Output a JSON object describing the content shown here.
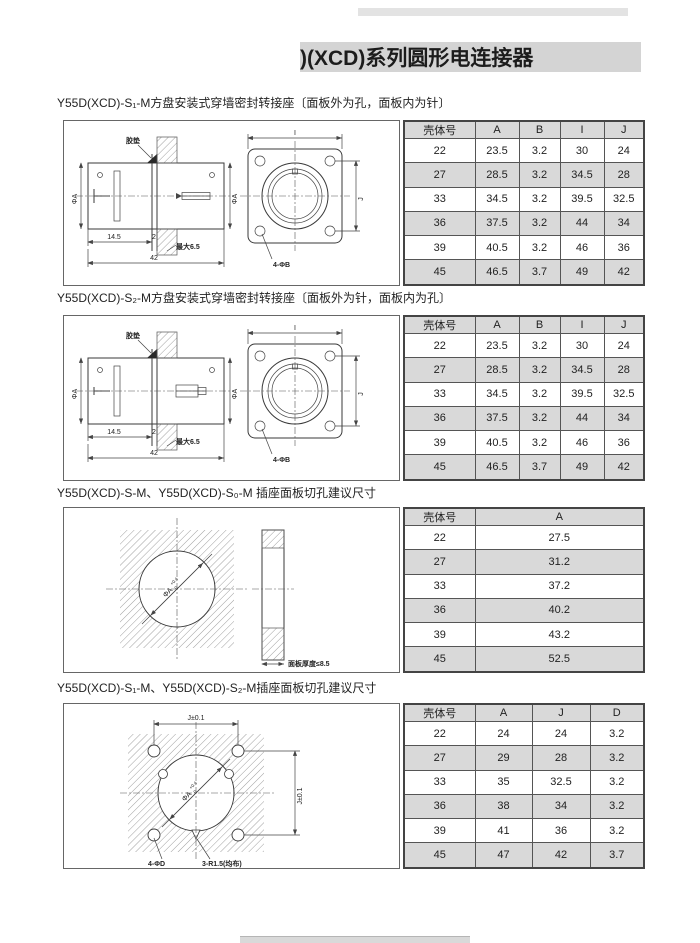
{
  "header": {
    "title": ")(XCD)系列圆形电连接器"
  },
  "sections": [
    {
      "title": "Y55D(XCD)-S₁-M方盘安装式穿墙密封转接座〔面板外为孔，面板内为针〕",
      "drawing": {
        "gasket_label": "胶垫",
        "phi_a_left": "ΦA",
        "phi_a_right": "ΦA",
        "dim_145": "14.5",
        "dim_2": "2",
        "dim_max65": "最大6.5",
        "dim_42": "42",
        "dim_i": "I",
        "dim_j": "J",
        "holes_label": "4-ΦB"
      },
      "table": {
        "columns": [
          "壳体号",
          "A",
          "B",
          "I",
          "J"
        ],
        "rows": [
          [
            "22",
            "23.5",
            "3.2",
            "30",
            "24"
          ],
          [
            "27",
            "28.5",
            "3.2",
            "34.5",
            "28"
          ],
          [
            "33",
            "34.5",
            "3.2",
            "39.5",
            "32.5"
          ],
          [
            "36",
            "37.5",
            "3.2",
            "44",
            "34"
          ],
          [
            "39",
            "40.5",
            "3.2",
            "46",
            "36"
          ],
          [
            "45",
            "46.5",
            "3.7",
            "49",
            "42"
          ]
        ]
      }
    },
    {
      "title": "Y55D(XCD)-S₂-M方盘安装式穿墙密封转接座〔面板外为针，面板内为孔〕",
      "drawing": {
        "gasket_label": "胶垫",
        "phi_a_left": "ΦA",
        "phi_a_right": "ΦA",
        "dim_145": "14.5",
        "dim_2": "2",
        "dim_max65": "最大6.5",
        "dim_42": "42",
        "dim_i": "I",
        "dim_j": "J",
        "holes_label": "4-ΦB"
      },
      "table": {
        "columns": [
          "壳体号",
          "A",
          "B",
          "I",
          "J"
        ],
        "rows": [
          [
            "22",
            "23.5",
            "3.2",
            "30",
            "24"
          ],
          [
            "27",
            "28.5",
            "3.2",
            "34.5",
            "28"
          ],
          [
            "33",
            "34.5",
            "3.2",
            "39.5",
            "32.5"
          ],
          [
            "36",
            "37.5",
            "3.2",
            "44",
            "34"
          ],
          [
            "39",
            "40.5",
            "3.2",
            "46",
            "36"
          ],
          [
            "45",
            "46.5",
            "3.7",
            "49",
            "42"
          ]
        ]
      }
    },
    {
      "title": "Y55D(XCD)-S-M、Y55D(XCD)-S₀-M 插座面板切孔建议尺寸",
      "drawing": {
        "phi_a": "ΦA",
        "tol_plus": "+0.4",
        "tol_zero": "0",
        "thickness_note": "面板厚度≤8.5"
      },
      "table": {
        "columns": [
          "壳体号",
          "A"
        ],
        "rows": [
          [
            "22",
            "27.5"
          ],
          [
            "27",
            "31.2"
          ],
          [
            "33",
            "37.2"
          ],
          [
            "36",
            "40.2"
          ],
          [
            "39",
            "43.2"
          ],
          [
            "45",
            "52.5"
          ]
        ]
      }
    },
    {
      "title": "Y55D(XCD)-S₁-M、Y55D(XCD)-S₂-M插座面板切孔建议尺寸",
      "drawing": {
        "dim_j_top": "J±0.1",
        "dim_j_right": "J±0.1",
        "phi_a": "ΦA",
        "tol_plus": "+0.4",
        "tol_zero": "0",
        "holes_label": "4-ΦD",
        "notch_label": "3-R1.5(均布)"
      },
      "table": {
        "columns": [
          "壳体号",
          "A",
          "J",
          "D"
        ],
        "rows": [
          [
            "22",
            "24",
            "24",
            "3.2"
          ],
          [
            "27",
            "29",
            "28",
            "3.2"
          ],
          [
            "33",
            "35",
            "32.5",
            "3.2"
          ],
          [
            "36",
            "38",
            "34",
            "3.2"
          ],
          [
            "39",
            "41",
            "36",
            "3.2"
          ],
          [
            "45",
            "47",
            "42",
            "3.7"
          ]
        ]
      }
    }
  ]
}
